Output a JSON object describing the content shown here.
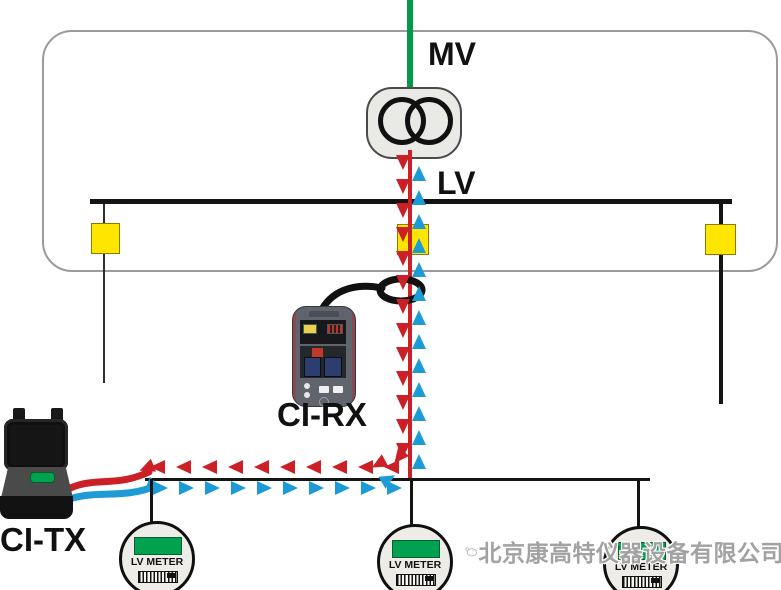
{
  "labels": {
    "mv": "MV",
    "lv": "LV",
    "ci_rx": "CI-RX",
    "ci_tx": "CI-TX"
  },
  "meters": [
    {
      "label": "LV METER"
    },
    {
      "label": "LV METER"
    },
    {
      "label": "LV METER"
    }
  ],
  "watermark": {
    "company": "北京康高特仪器设备有限公司"
  },
  "colors": {
    "mv_green": "#009a49",
    "signal_red": "#cc2027",
    "signal_blue": "#1d9bd6",
    "fuse_yellow": "#ffe600",
    "line_black": "#141414",
    "outline_gray": "#9b9b9b",
    "meter_display_green": "#00a24f",
    "watermark_gray": "#a2a2a2"
  }
}
